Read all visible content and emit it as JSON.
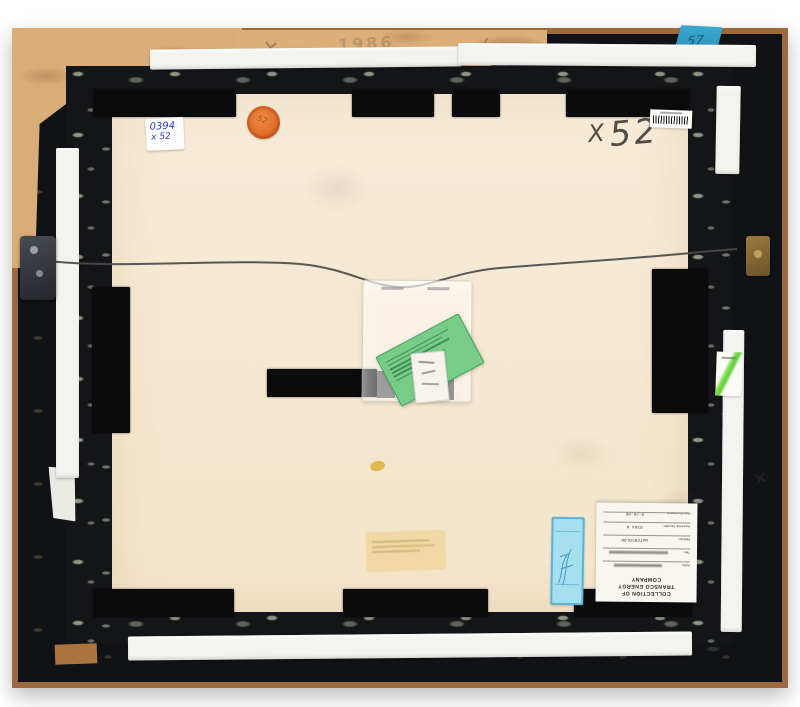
{
  "scene": {
    "description": "Photograph of the verso (back) of a framed artwork: black marbled frame, cream backing board, hanging wire, tapes and collection labels",
    "backdrop_color": "#ffffff",
    "frame_black": "#141519",
    "wood_edge": "#9b6a3c",
    "kraft_paper": "#d9ad79",
    "backing_paper": "#f5e9d2",
    "tape_white": "#f3f3ef",
    "velvet_black": "#0b0b0c",
    "wire_gray": "#4a4a4a"
  },
  "stickers": {
    "corner_sticker": {
      "line1": "0394",
      "line2": "x 52",
      "ink_color": "#2d3fc0"
    },
    "orange_dot": {
      "text": "52",
      "color": "#e06f2c"
    },
    "blue_tape": {
      "text": "57",
      "color": "#2f9dc9"
    },
    "green_card_color": "#77cc88",
    "cyan_label_color": "#a5dff0",
    "ghost_label_color": "#f0d89e"
  },
  "handwriting": {
    "charcoal_x": "X",
    "charcoal_number": "52",
    "pencil_x_mark": "✕",
    "pencil_year": "1986",
    "pencil_check_mark": "✓",
    "edge_mark": "✕"
  },
  "collection_label": {
    "header_line1": "COLLECTION OF",
    "header_line2": "TRANSCO ENERGY COMPANY",
    "fields": [
      {
        "label": "Artist:",
        "value": ""
      },
      {
        "label": "Title:",
        "value": ""
      },
      {
        "label": "Medium:",
        "value": "WATERCOLOR"
      },
      {
        "label": "Accession Number:",
        "value": "0394 W"
      },
      {
        "label": "Date Purchased:",
        "value": "9-26-86"
      }
    ]
  }
}
